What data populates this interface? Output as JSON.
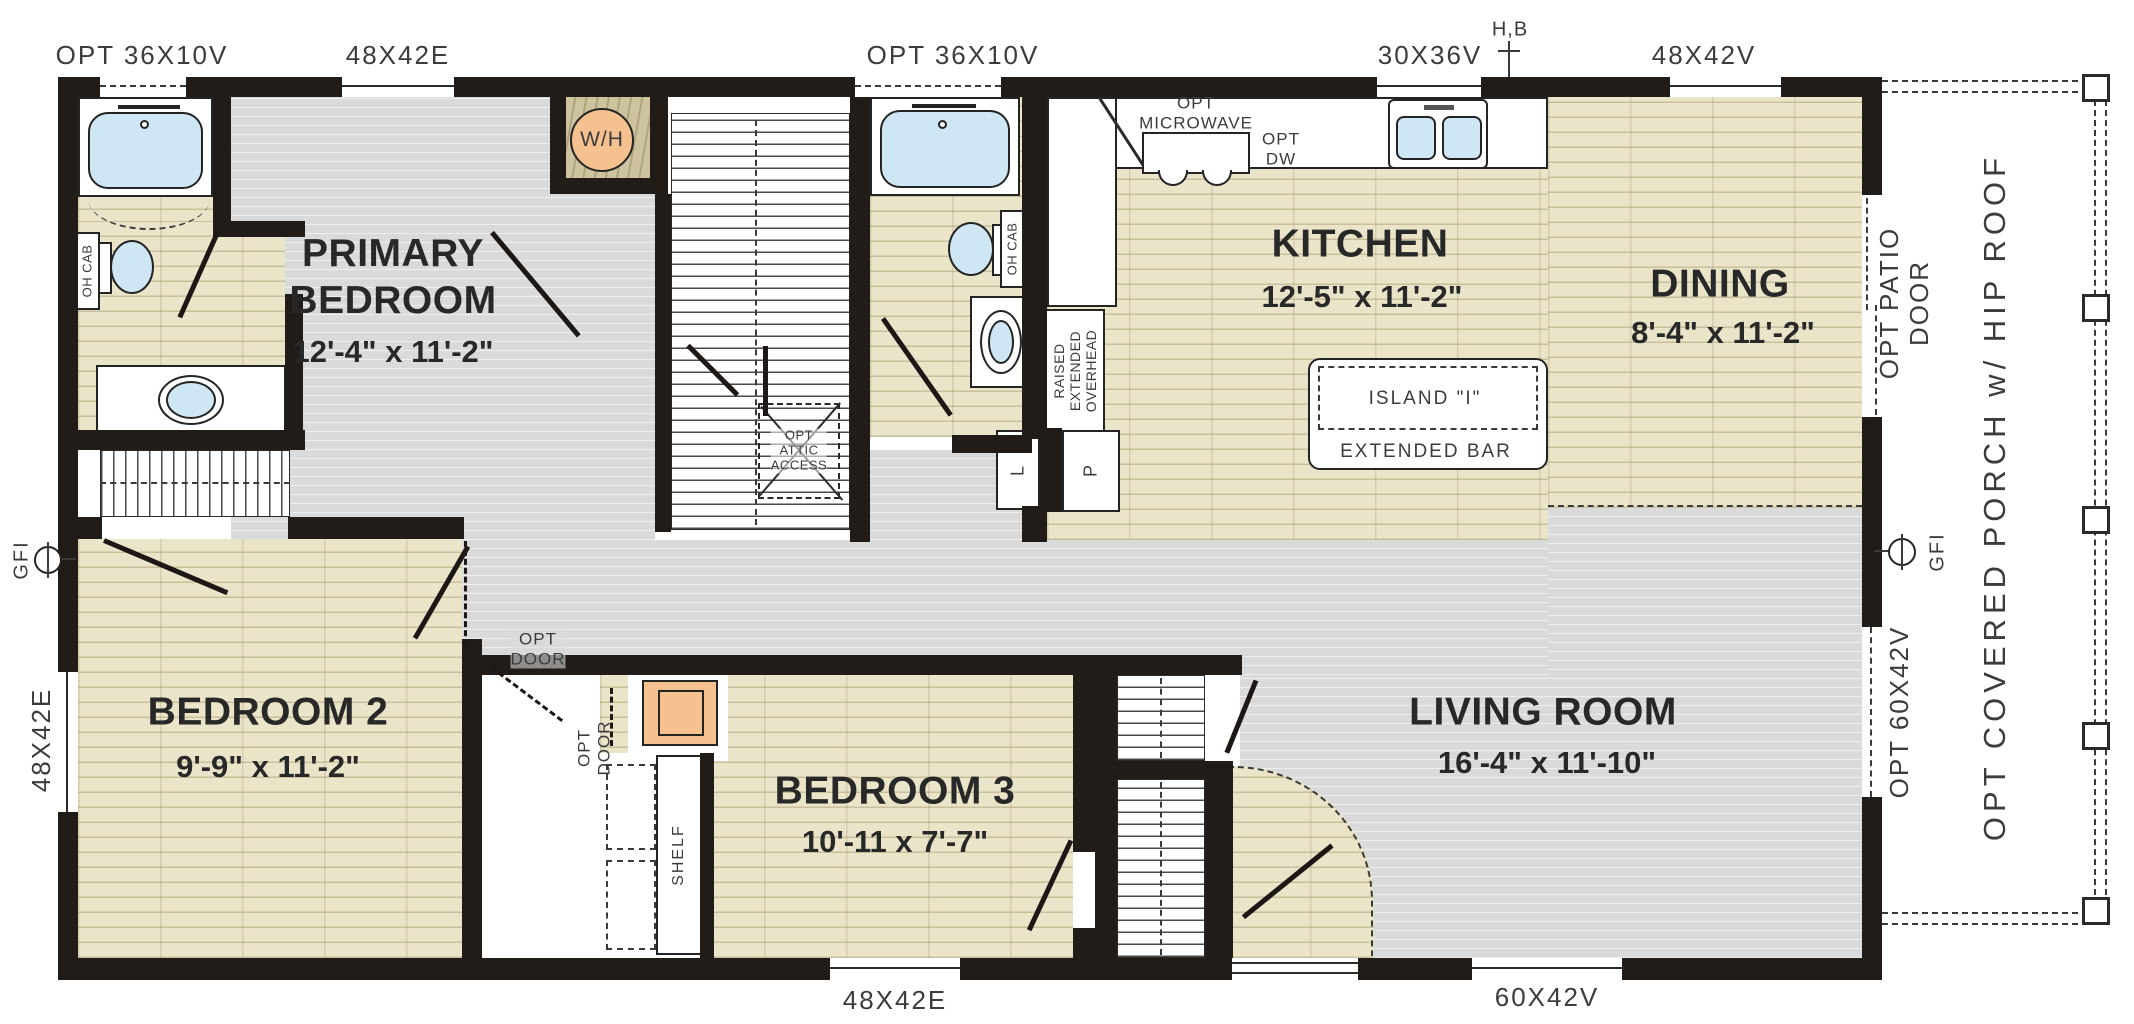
{
  "rooms": {
    "primary": {
      "name": "PRIMARY\nBEDROOM",
      "dims": "12'-4\" x 11'-2\""
    },
    "kitchen": {
      "name": "KITCHEN",
      "dims": "12'-5\" x 11'-2\""
    },
    "dining": {
      "name": "DINING",
      "dims": "8'-4\" x 11'-2\""
    },
    "bedroom2": {
      "name": "BEDROOM 2",
      "dims": "9'-9\" x 11'-2\""
    },
    "bedroom3": {
      "name": "BEDROOM 3",
      "dims": "10'-11 x 7'-7\""
    },
    "living": {
      "name": "LIVING ROOM",
      "dims": "16'-4\" x 11'-10\""
    }
  },
  "window_labels": {
    "top_left_opt": "OPT 36X10V",
    "top_left_e": "48X42E",
    "top_mid_opt": "OPT 36X10V",
    "top_kitchen": "30X36V",
    "hose_bib": "H,B",
    "top_dining": "48X42V",
    "bottom_bed3": "48X42E",
    "bottom_living": "60X42V",
    "left_bed2": "48X42E",
    "right_living": "OPT 60X42V"
  },
  "side_labels": {
    "patio_door": "OPT PATIO DOOR",
    "porch": "OPT COVERED PORCH w/ HIP ROOF",
    "gfi": "GFI"
  },
  "fixtures": {
    "water_heater": "W/H",
    "overhead_cabinet": "OH CAB",
    "opt_microwave": "OPT\nMICROWAVE",
    "opt_dw": "OPT\nDW",
    "island": "ISLAND \"I\"",
    "extended_bar": "EXTENDED BAR",
    "raised_overhead": "RAISED\nEXTENDED\nOVERHEAD",
    "attic_access": "OPT\nATTIC\nACCESS",
    "opt_door": "OPT\nDOOR",
    "shelf": "SHELF",
    "linen": "L",
    "pantry": "P"
  },
  "colors": {
    "wall": "#211c18",
    "floor_wood": "#eae4c9",
    "floor_gray": "#dadada",
    "fixture_blue": "#cfe7f4",
    "accent_orange": "#f4c18f",
    "wh_closet_tan": "#cdc39f"
  }
}
